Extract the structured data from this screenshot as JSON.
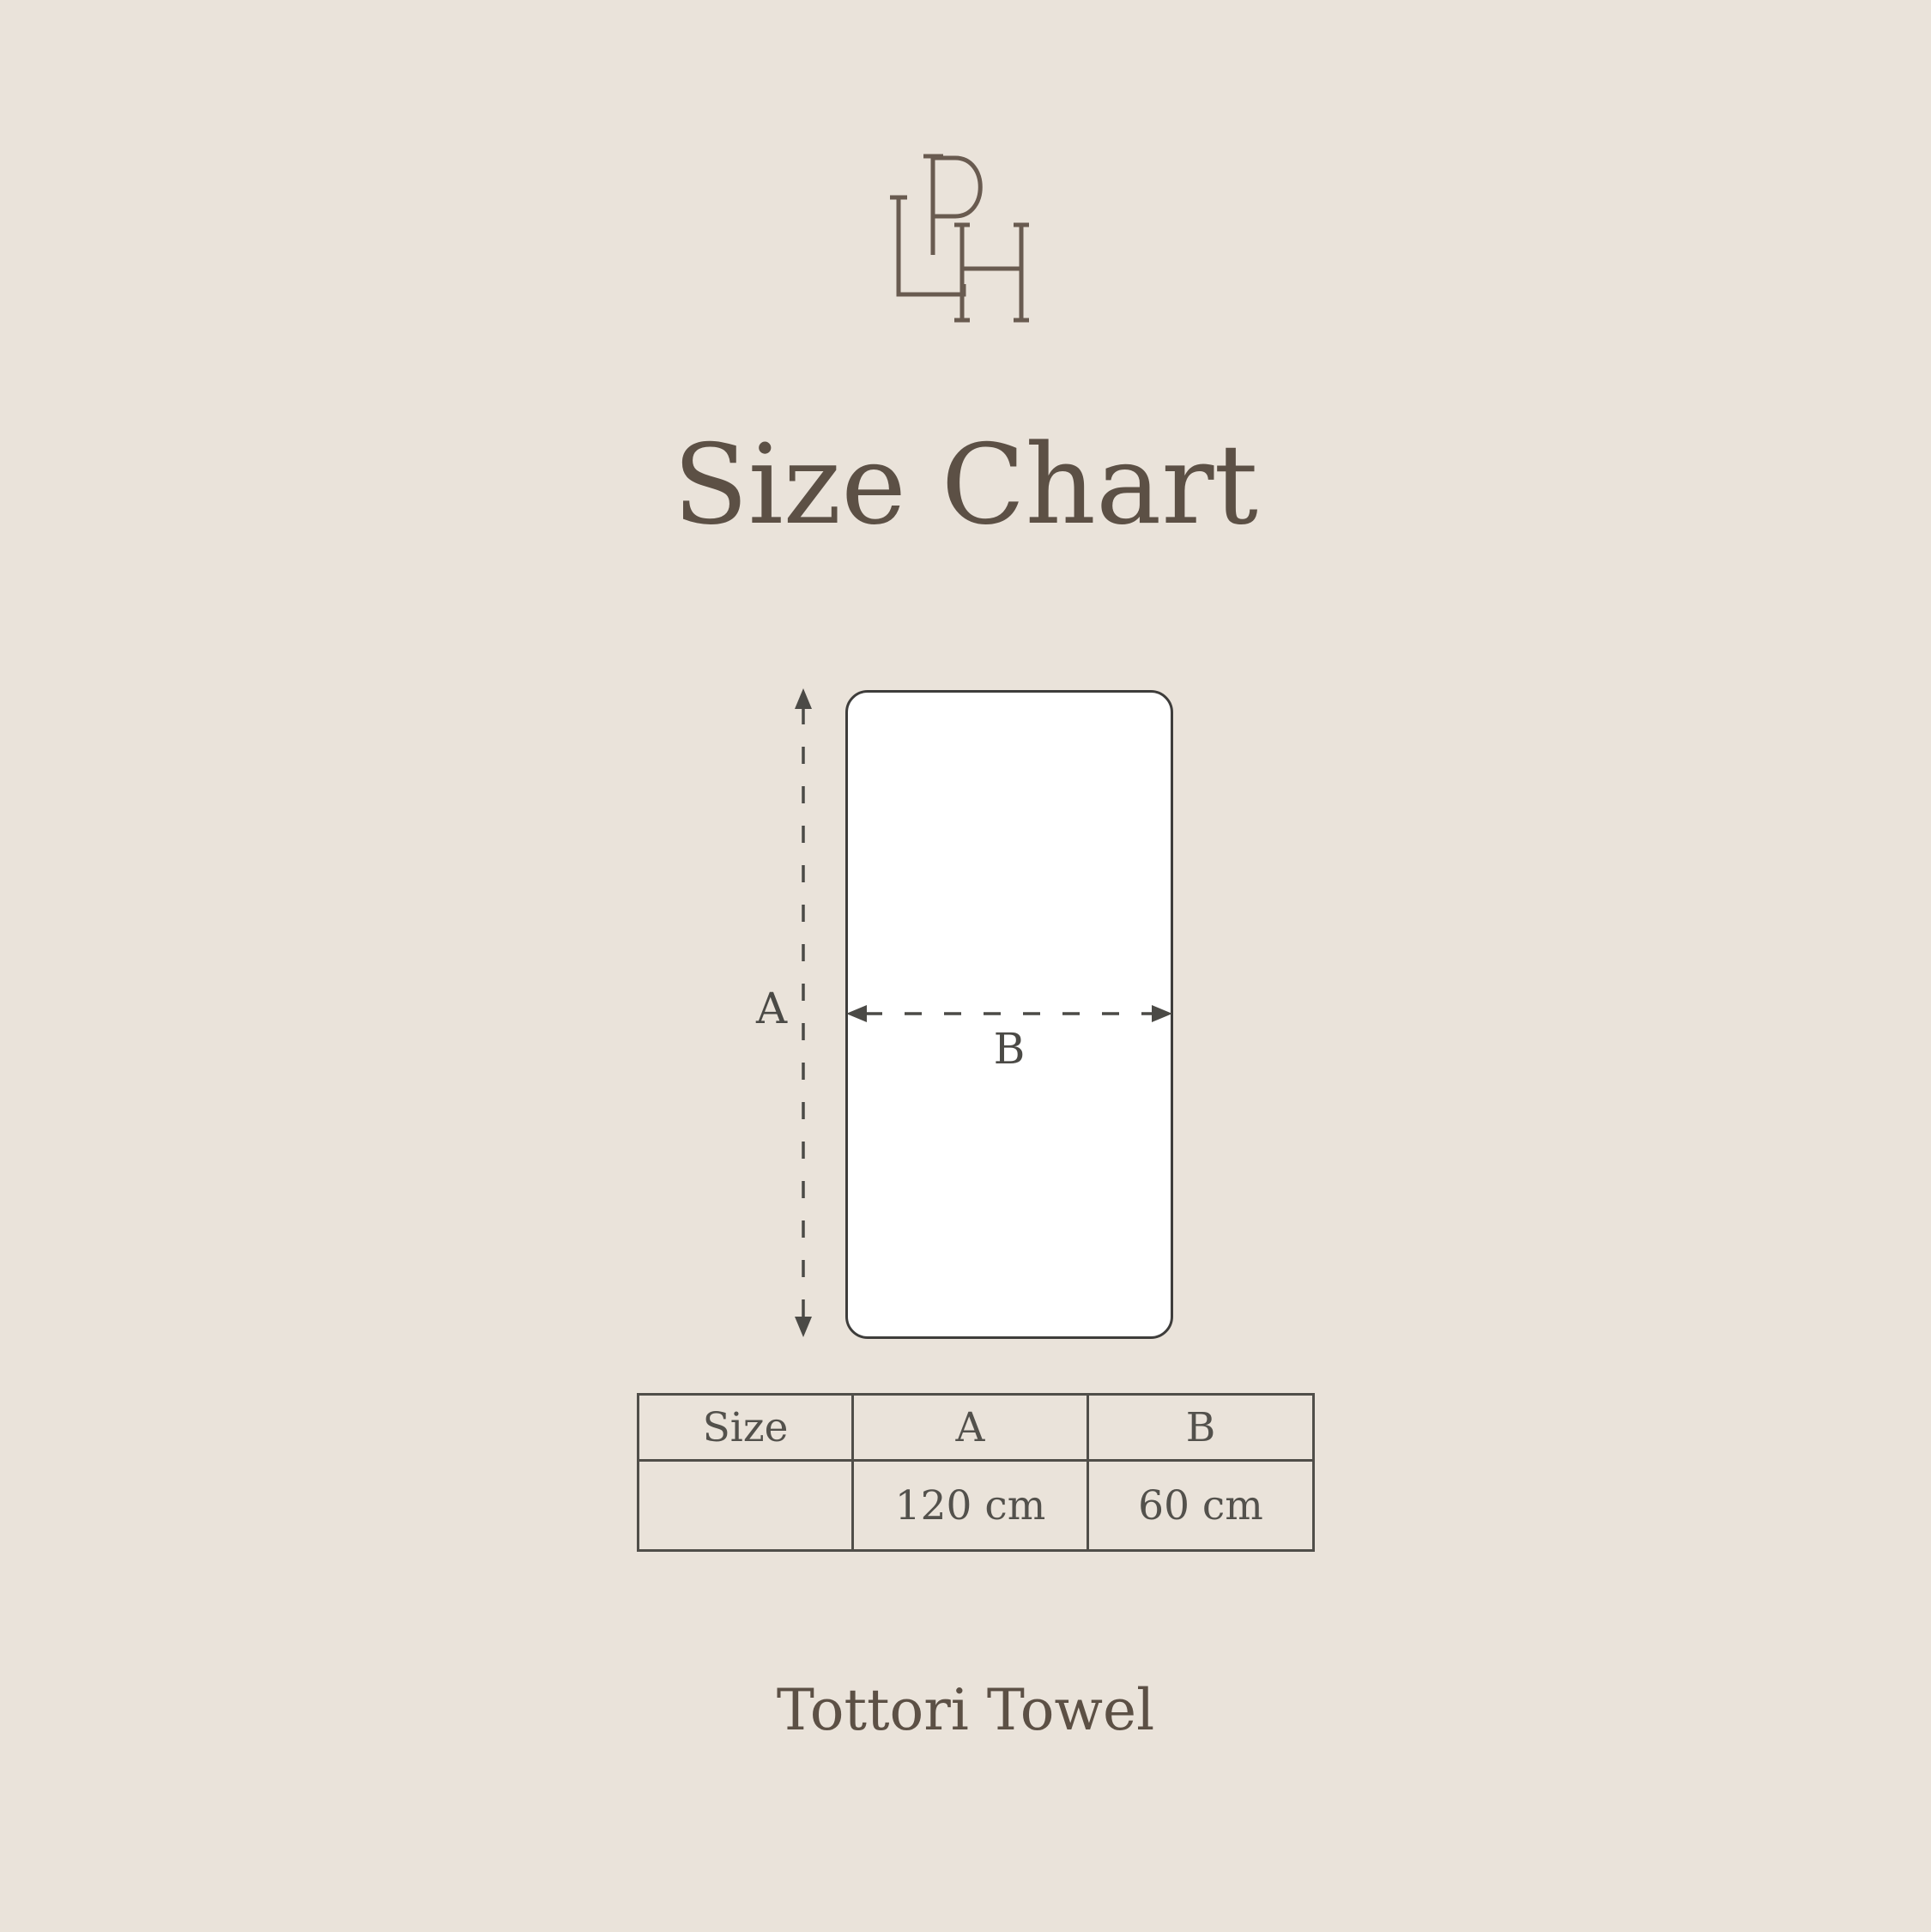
{
  "page": {
    "background_color": "#EAE3DA"
  },
  "logo": {
    "letters": "LPH",
    "color": "#695B50"
  },
  "title": {
    "text": "Size Chart",
    "color": "#5C5045"
  },
  "diagram": {
    "label_a": "A",
    "label_b": "B",
    "towel_fill": "#FFFFFF",
    "line_color": "#4B4A46"
  },
  "table": {
    "border_color": "#504E49",
    "text_color": "#53514C",
    "headers": [
      "Size",
      "A",
      "B"
    ],
    "rows": [
      {
        "size": "",
        "a": "120 cm",
        "b": "60 cm"
      }
    ]
  },
  "footer": {
    "text": "Tottori Towel",
    "color": "#5C5045"
  }
}
